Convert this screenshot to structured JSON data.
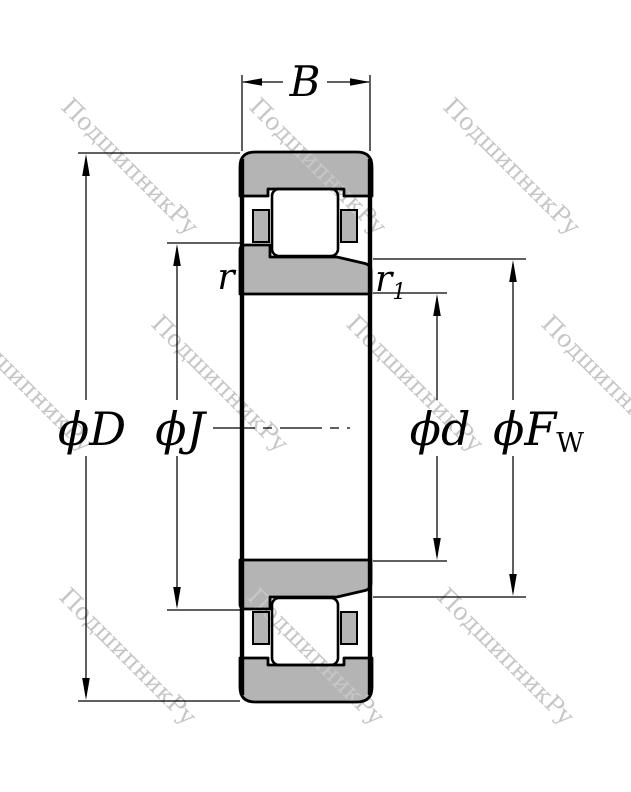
{
  "watermark": {
    "text": "ПодшипникРу",
    "color": "#c6c6c6"
  },
  "dimension_labels": {
    "width": "B",
    "outer_chamfer": "r",
    "inner_chamfer": {
      "base": "r",
      "sub": "1"
    },
    "outer_diameter": "ϕD",
    "inner_rib_diameter": "ϕJ",
    "bore_diameter": "ϕd",
    "raceway_diameter": {
      "base": "ϕF",
      "sub": "W"
    }
  },
  "colors": {
    "ring_fill": "#b4b4b4",
    "roller_fill": "#ffffff",
    "line": "#000000"
  }
}
